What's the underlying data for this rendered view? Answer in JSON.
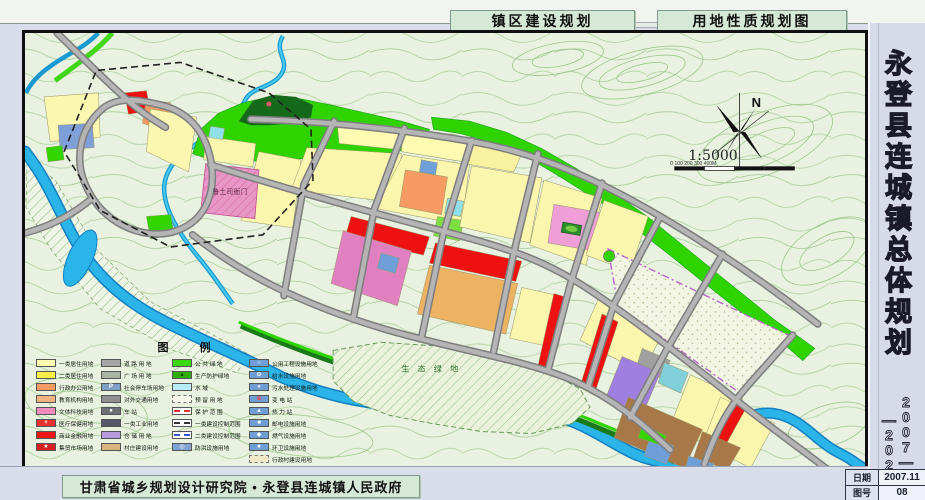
{
  "header": {
    "tab1": "镇区建设规划",
    "tab2": "用地性质规划图"
  },
  "sidebar": {
    "title": "永登县连城镇总体规划",
    "year_right": "2007—",
    "year_left": "—2020"
  },
  "footer": {
    "credit": "甘肃省城乡规划设计研究院 • 永登县连城镇人民政府"
  },
  "title_block": {
    "date_label": "日期",
    "date_value": "2007.11",
    "sheet_label": "图号",
    "sheet_value": "08"
  },
  "map": {
    "labels": {
      "historic_site": "鲁土司衙门",
      "eco_green": "生 态 绿 地"
    },
    "compass_n": "N",
    "scale_text": "1:5000",
    "scale_ticks": "0    100    200    300   400M"
  },
  "colors": {
    "river": "#2ab4e8",
    "green_belt": "#2fd400",
    "residential": "#faf6ae",
    "commercial_red": "#ee1111",
    "admin_orange": "#f59b63",
    "culture_magenta": "#e080c0",
    "road_gray": "#b5b5b5",
    "utility_blue": "#7fa3d4"
  },
  "legend": {
    "title": "图    例",
    "columns": [
      [
        {
          "label": "一类居住用地",
          "type": "fill",
          "color": "#fdfab2"
        },
        {
          "label": "二类居住用地",
          "type": "fill",
          "color": "#f8f049"
        },
        {
          "label": "行政办公用地",
          "type": "fill",
          "color": "#f59b63"
        },
        {
          "label": "教育机构用地",
          "type": "fill",
          "color": "#f4b183"
        },
        {
          "label": "文体科技用地",
          "type": "fill",
          "color": "#f08cc0"
        },
        {
          "label": "医疗保健用地",
          "type": "fill",
          "color": "#e83030",
          "glyph": "+",
          "glyphColor": "#ffffff"
        },
        {
          "label": "商业金融用地",
          "type": "fill",
          "color": "#ee1717"
        },
        {
          "label": "集贸市场用地",
          "type": "fill",
          "color": "#d42020",
          "glyph": "★",
          "glyphColor": "#ffffff"
        }
      ],
      [
        {
          "label": "道 路 用 地",
          "type": "fill",
          "color": "#a6a6a6"
        },
        {
          "label": "广 场 用 地",
          "type": "fill",
          "color": "#a9b4a3"
        },
        {
          "label": "社会停车场用地",
          "type": "fill",
          "color": "#7f9fc6",
          "glyph": "P",
          "glyphColor": "#ffffff"
        },
        {
          "label": "对外交通用地",
          "type": "fill",
          "color": "#8f8f8f"
        },
        {
          "label": "车    站",
          "type": "fill",
          "color": "#6f6f78",
          "glyph": "●",
          "glyphColor": "#ffffff"
        },
        {
          "label": "一类工业用地",
          "type": "fill",
          "color": "#55566a"
        },
        {
          "label": "仓 储 用 地",
          "type": "fill",
          "color": "#b79de0"
        },
        {
          "label": "村庄建设用地",
          "type": "fill",
          "color": "#d9b380"
        }
      ],
      [
        {
          "label": "公 共 绿 地",
          "type": "fill",
          "color": "#3bd80f"
        },
        {
          "label": "生产防护绿地",
          "type": "fill",
          "color": "#2fae06",
          "glyph": "▲",
          "glyphColor": "#0b4d0b"
        },
        {
          "label": "水    域",
          "type": "fill",
          "color": "#b5ecf8"
        },
        {
          "label": "预 留 用 地",
          "type": "reserve",
          "color": "#f6f6ea"
        },
        {
          "label": "保 护 范 围",
          "type": "line",
          "color": "#e03030"
        },
        {
          "label": "一类建设控制范围",
          "type": "line",
          "color": "#333333"
        },
        {
          "label": "二类建设控制范围",
          "type": "line",
          "color": "#3355cc"
        },
        {
          "label": "防洪设施用地",
          "type": "fill",
          "color": "#7fa3d4",
          "glyph": "◎",
          "glyphColor": "#ffffff"
        }
      ],
      [
        {
          "label": "公用工程设施用地",
          "type": "fill",
          "color": "#6f9ed4",
          "glyph": "○",
          "glyphColor": "#ffffff"
        },
        {
          "label": "给水设施用地",
          "type": "fill",
          "color": "#6f9ed4",
          "glyph": "⊙",
          "glyphColor": "#ffffff"
        },
        {
          "label": "污水处理设施用地",
          "type": "fill",
          "color": "#6f9ed4",
          "glyph": "●",
          "glyphColor": "#dfe8ff"
        },
        {
          "label": "变  电  站",
          "type": "fill",
          "color": "#6f9ed4",
          "glyph": "⊕",
          "glyphColor": "#ff4040"
        },
        {
          "label": "热  力  站",
          "type": "fill",
          "color": "#6f9ed4",
          "glyph": "▲",
          "glyphColor": "#ffffff"
        },
        {
          "label": "邮电设施用地",
          "type": "fill",
          "color": "#6f9ed4",
          "glyph": "■",
          "glyphColor": "#ffffff"
        },
        {
          "label": "燃气设施用地",
          "type": "fill",
          "color": "#6f9ed4",
          "glyph": "◆",
          "glyphColor": "#ffffff"
        },
        {
          "label": "环卫设施用地",
          "type": "fill",
          "color": "#6f9ed4",
          "glyph": "★",
          "glyphColor": "#ffffff"
        },
        {
          "label": "行政村建设用地",
          "type": "reserve",
          "color": "#efe9c8"
        }
      ]
    ]
  }
}
